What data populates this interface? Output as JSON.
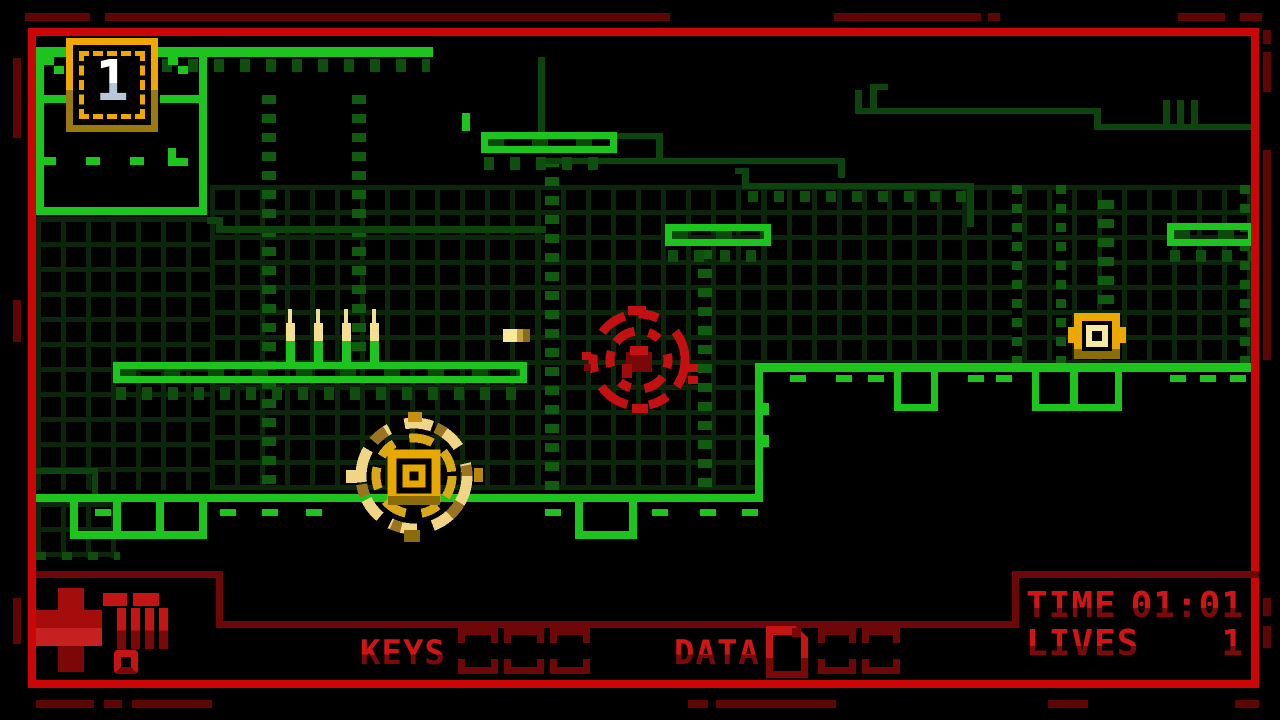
{
  "window": {
    "title": "pixel platformer level view"
  },
  "level": {
    "key_badge_count": "1",
    "entities": [
      {
        "name": "player-gear",
        "color": "#f0d585"
      },
      {
        "name": "enemy-saw",
        "color": "#c41010"
      },
      {
        "name": "gold-box",
        "color": "#eca800"
      },
      {
        "name": "spike-row",
        "count": 4,
        "color": "#f2e090"
      },
      {
        "name": "bullet",
        "color": "#f8e89a"
      },
      {
        "name": "key-badge",
        "value": "1"
      }
    ]
  },
  "hud": {
    "keys_label": "KEYS",
    "key_slots_total": 3,
    "key_slots_filled": 0,
    "data_label": "DATA",
    "data_slots_total": 3,
    "data_collected": 1,
    "time_label": "TIME",
    "time_value": "01:01",
    "lives_label": "LIVES",
    "lives_value": "1",
    "health_icon": "red-cross-with-meter"
  },
  "colors": {
    "platform_green": "#1dc41d",
    "circuit_dark_green": "#0d440d",
    "border_red": "#cc0606",
    "hud_dark_red": "#6e0808",
    "text_red": "#d41414",
    "gold": "#eca800",
    "pale_yellow": "#f2de85"
  }
}
